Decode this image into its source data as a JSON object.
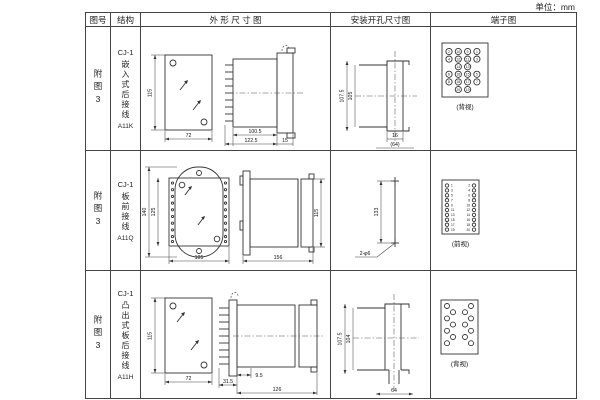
{
  "unit_label": "单位：mm",
  "table": {
    "headers": {
      "fig_no": "图号",
      "structure": "结构",
      "outline": "外 形 尺 寸 图",
      "mounting": "安装开孔尺寸图",
      "terminal": "端子图"
    },
    "rows": [
      {
        "fig_no": "附图3",
        "structure": {
          "model": "CJ-1",
          "type": "嵌入式后接线",
          "code": "A11K"
        },
        "outline": {
          "front_h": "115",
          "front_w": "72",
          "d1": "100.5",
          "d2": "122.5",
          "d3": "15"
        },
        "mounting": {
          "v1": "107.5",
          "v2": "105",
          "h1": "16",
          "h2": "(64)"
        },
        "terminal": {
          "caption": "(背视)",
          "layout": "grid",
          "grid": [
            [
              "2",
              "10",
              "9",
              "1"
            ],
            [
              "4",
              "12",
              "11",
              "3"
            ],
            [
              "",
              "14",
              "13",
              ""
            ],
            [
              "6",
              "16",
              "15",
              "5"
            ],
            [
              "8",
              "18",
              "17",
              "7"
            ],
            [
              "",
              "20",
              "19",
              ""
            ]
          ]
        }
      },
      {
        "fig_no": "附图3",
        "structure": {
          "model": "CJ-1",
          "type": "板前接线",
          "code": "A11Q"
        },
        "outline": {
          "front_h_outer": "140",
          "front_h_inner": "125",
          "front_w": "105",
          "side_len": "156",
          "side_h": "115"
        },
        "mounting": {
          "v1": "133",
          "hole_label": "2-φ6"
        },
        "terminal": {
          "caption": "(前视)",
          "layout": "columns",
          "left": [
            "1",
            "3",
            "5",
            "7",
            "9",
            "11",
            "13",
            "15",
            "17",
            "19"
          ],
          "right": [
            "2",
            "4",
            "6",
            "8",
            "10",
            "12",
            "14",
            "16",
            "18",
            "20"
          ]
        }
      },
      {
        "fig_no": "附图3",
        "structure": {
          "model": "CJ-1",
          "type": "凸出式板后接线",
          "code": "A11H"
        },
        "outline": {
          "front_h": "115",
          "front_w": "72",
          "d1": "31.5",
          "d2": "9.5",
          "d3": "126"
        },
        "mounting": {
          "v1": "107.5",
          "v2": "104",
          "h1": "64"
        },
        "terminal": {
          "caption": "(背视)",
          "layout": "staggered",
          "count": 14
        }
      }
    ]
  }
}
